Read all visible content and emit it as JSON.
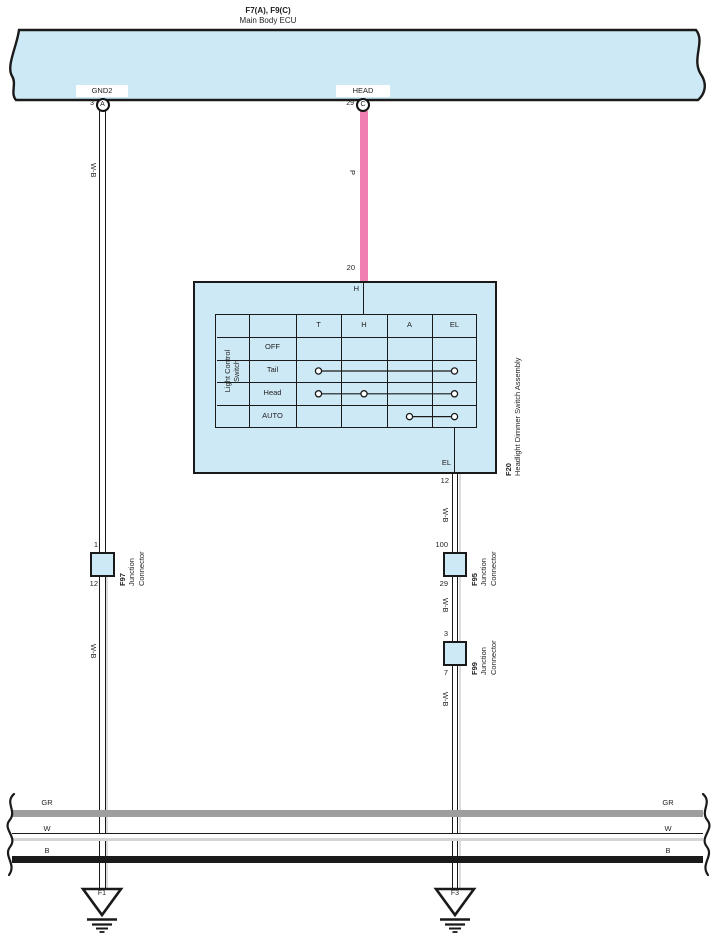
{
  "ecu": {
    "ref": "F7(A), F9(C)",
    "name": "Main Body ECU",
    "pins": {
      "gnd2": {
        "label": "GND2",
        "number": "3",
        "connector": "A"
      },
      "head": {
        "label": "HEAD",
        "number": "29",
        "connector": "C"
      }
    }
  },
  "wire_labels": {
    "pink": "P",
    "wb": "W-B"
  },
  "switch_assembly": {
    "ref": "F20",
    "name": "Headlight Dimmer Switch Assembly",
    "top_pin": {
      "number": "20",
      "terminal": "H"
    },
    "bottom_pin": {
      "number": "12",
      "terminal": "EL"
    },
    "switch_name_line1": "Light Control",
    "switch_name_line2": "Switch",
    "columns": [
      "T",
      "H",
      "A",
      "EL"
    ],
    "rows": [
      {
        "label": "OFF",
        "contacts": []
      },
      {
        "label": "Tail",
        "contacts": [
          "T",
          "EL"
        ]
      },
      {
        "label": "Head",
        "contacts": [
          "T",
          "H",
          "EL"
        ]
      },
      {
        "label": "AUTO",
        "contacts": [
          "A",
          "EL"
        ]
      }
    ]
  },
  "connectors": [
    {
      "ref": "F97",
      "name_line1": "Junction",
      "name_line2": "Connector",
      "pin_top": "1",
      "pin_bottom": "12"
    },
    {
      "ref": "F95",
      "name_line1": "Junction",
      "name_line2": "Connector",
      "pin_top": "100",
      "pin_bottom": "29"
    },
    {
      "ref": "F99",
      "name_line1": "Junction",
      "name_line2": "Connector",
      "pin_top": "3",
      "pin_bottom": "7"
    }
  ],
  "ground_wires": [
    {
      "label": "GR"
    },
    {
      "label": "W"
    },
    {
      "label": "B"
    }
  ],
  "grounds": [
    {
      "ref": "F1"
    },
    {
      "ref": "F3"
    }
  ],
  "colors": {
    "component_fill": "#CEE9F6",
    "wire_pink": "#F07EB2",
    "wire_gray": "#9E9E9E",
    "wire_black": "#1A1A1A",
    "wire_shadow": "#DCDCDC"
  }
}
